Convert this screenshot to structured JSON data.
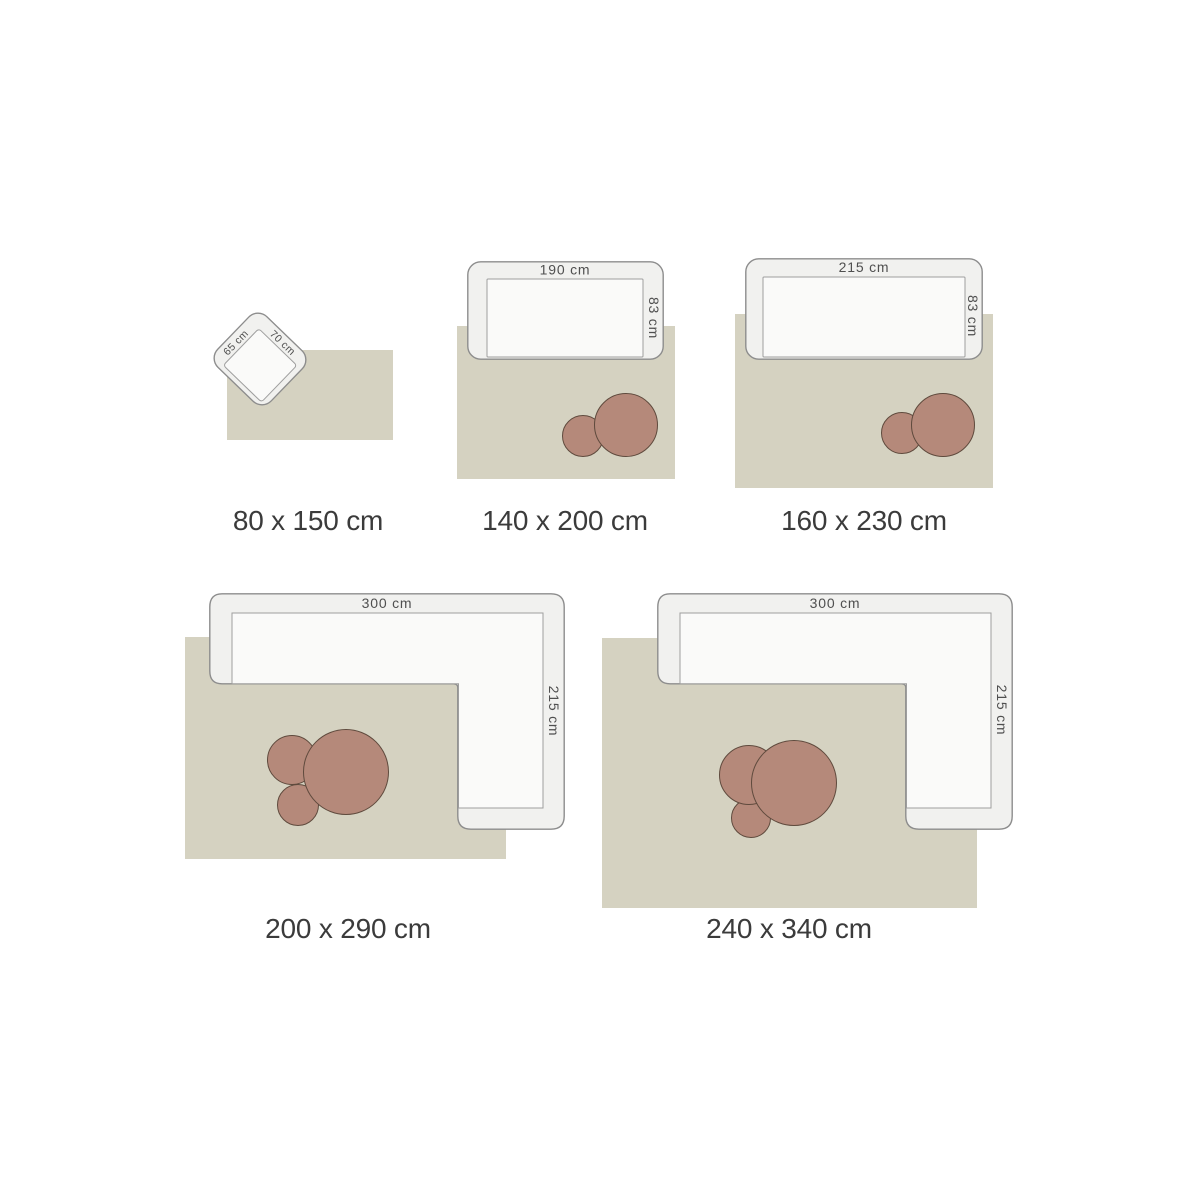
{
  "title": "rug-size-guide",
  "colors": {
    "background": "#ffffff",
    "rug": "#d5d2c1",
    "furniture-fill": "#f1f1ef",
    "furniture-stroke": "#8d8d8d",
    "seat-fill": "#fafaf9",
    "seat-stroke": "#9e9e9e",
    "table-fill": "#b5897a",
    "table-stroke": "#5f4a3d",
    "dimension-text": "#4f4f4f",
    "size-text": "#3b3b3b"
  },
  "panels": [
    {
      "id": "80x150",
      "label": "80 x 150 cm",
      "furniture": "armchair",
      "dims": {
        "width_label": "70 cm",
        "depth_label": "65 cm"
      },
      "tables": 0
    },
    {
      "id": "140x200",
      "label": "140 x 200 cm",
      "furniture": "sofa",
      "dims": {
        "width_label": "190 cm",
        "depth_label": "83 cm"
      },
      "tables": 2
    },
    {
      "id": "160x230",
      "label": "160 x 230 cm",
      "furniture": "sofa",
      "dims": {
        "width_label": "215 cm",
        "depth_label": "83 cm"
      },
      "tables": 2
    },
    {
      "id": "200x290",
      "label": "200 x 290 cm",
      "furniture": "corner-sofa",
      "dims": {
        "width_label": "300 cm",
        "depth_label": "215 cm"
      },
      "tables": 3
    },
    {
      "id": "240x340",
      "label": "240 x 340 cm",
      "furniture": "corner-sofa",
      "dims": {
        "width_label": "300 cm",
        "depth_label": "215 cm"
      },
      "tables": 3
    }
  ]
}
